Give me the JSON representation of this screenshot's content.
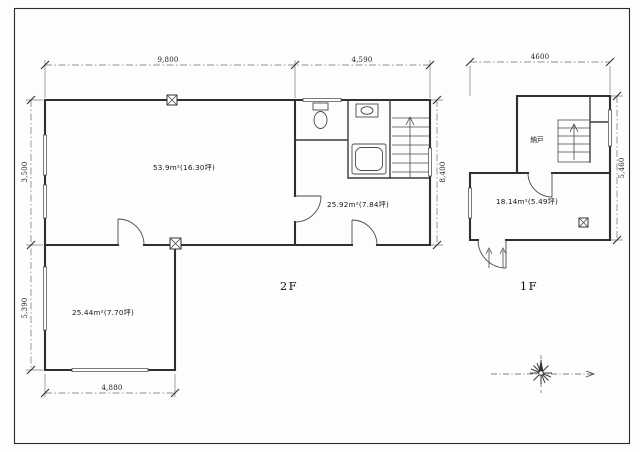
{
  "sheet": {
    "paper_color": "#fdfdfb",
    "ink_color": "#2f2f2f",
    "type": "scanned architectural floor plan"
  },
  "floor2": {
    "label": "2F",
    "areas": {
      "main": "53.9m²(16.30坪)",
      "middle": "25.92m²(7.84坪)",
      "wing": "25.44m²(7.70坪)"
    },
    "dims": {
      "top_left": "9,800",
      "top_right": "4,590",
      "left_upper": "3,500",
      "left_lower": "5,390",
      "bottom": "4,880",
      "right": "8,400"
    }
  },
  "floor1": {
    "label": "1F",
    "areas": {
      "main": "18.14m²(5.49坪)"
    },
    "room_labels": {
      "storage": "納戸"
    },
    "dims": {
      "top": "4600",
      "right": "5,460"
    }
  },
  "icons": {
    "compass": "compass-rose-icon",
    "stairs_arrow": "up-arrow-icon",
    "entrance_arrows": "entry-direction-arrows-icon",
    "column_marker": "x-box-column-icon"
  }
}
